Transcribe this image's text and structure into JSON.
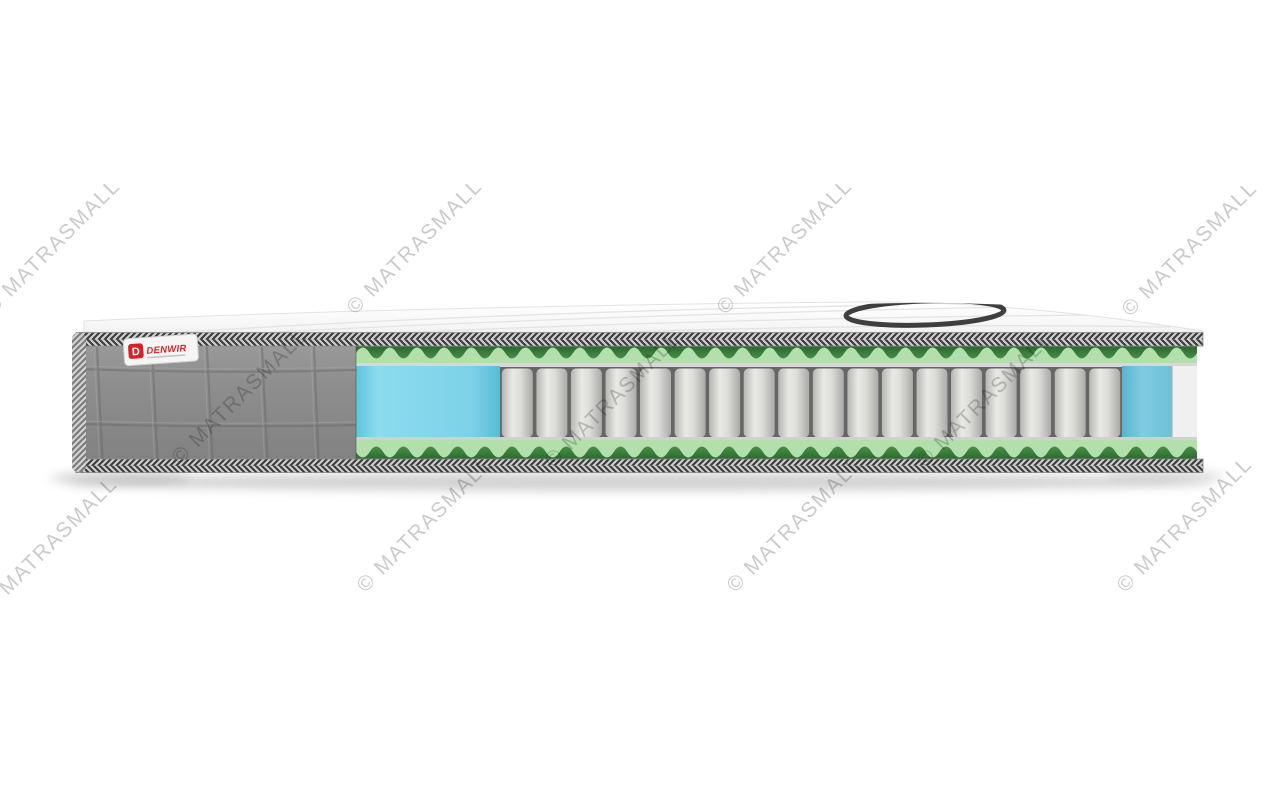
{
  "image": {
    "description": "Cutaway product photo of a pocket-spring mattress on white background",
    "background": "#ffffff"
  },
  "watermark": {
    "text": "© MATRASMALL",
    "color": "#cbcbcb",
    "angle_deg": -45,
    "font_size_px": 21,
    "positions": [
      {
        "x": 53,
        "y": 247
      },
      {
        "x": 415,
        "y": 247
      },
      {
        "x": 785,
        "y": 247
      },
      {
        "x": 1190,
        "y": 249
      },
      {
        "x": 240,
        "y": 397
      },
      {
        "x": 613,
        "y": 400
      },
      {
        "x": 985,
        "y": 400
      },
      {
        "x": 50,
        "y": 545
      },
      {
        "x": 425,
        "y": 525
      },
      {
        "x": 795,
        "y": 525
      },
      {
        "x": 1185,
        "y": 525
      }
    ]
  },
  "brand_label": {
    "icon_letter": "D",
    "text": "DENWIR",
    "text_color": "#d42328",
    "background": "#f5f5f5"
  },
  "mattress": {
    "springs": {
      "count": 18
    },
    "wave_foam": {
      "periods": 31
    },
    "layers": [
      {
        "name": "quilted-top-cover",
        "color": "#fafafa"
      },
      {
        "name": "edge-tape",
        "color_dark": "#3a3a3a",
        "color_light": "#cfcfcf"
      },
      {
        "name": "wave-foam-top",
        "color_light": "#b3dfac",
        "color_dark": "#2e7033"
      },
      {
        "name": "felt-liner-top",
        "color": "#d8d8d8"
      },
      {
        "name": "foam-block-left",
        "color": "#85d7ea"
      },
      {
        "name": "pocket-springs",
        "color_fill": "#dedede",
        "color_gap": "#666666"
      },
      {
        "name": "foam-block-right",
        "color": "#79c8dc"
      },
      {
        "name": "felt-liner-bottom",
        "color": "#d0d0d0"
      },
      {
        "name": "wave-foam-bottom",
        "color_light": "#b3dfac",
        "color_dark": "#2e7033"
      },
      {
        "name": "quilted-side-cover",
        "color": "#8e8e8e"
      },
      {
        "name": "top-logo-print",
        "color": "#1f1f1f"
      }
    ]
  },
  "colors": {
    "bg": "#ffffff",
    "wm-color": "#cbcbcb",
    "tape-dark": "#3a3a3a",
    "tape-light": "#cfcfcf",
    "foam-green-light": "#b3dfac",
    "felt": "#d8d8d8",
    "felt-bottom": "#d0d0d0",
    "spring-bg": "#666666",
    "ring": "#1f1f1f",
    "label-red": "#d42328",
    "quilt-groove": "#6b6b6b",
    "cut-end": "#f0f0f0"
  }
}
